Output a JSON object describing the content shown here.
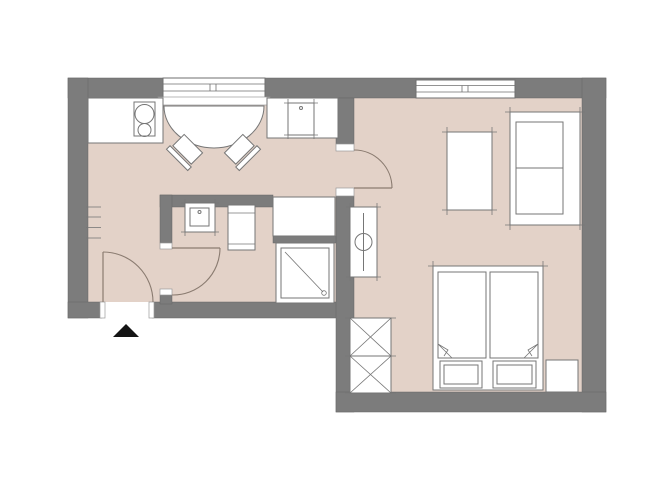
{
  "title": "Apartment floor plan",
  "canvas": {
    "width": 670,
    "height": 503,
    "background": "#ffffff"
  },
  "colors": {
    "wall": "#7c7c7c",
    "wall_edge": "#676767",
    "floor": "#e3d2c8",
    "furniture_fill": "#ffffff",
    "furniture_line": "#767676",
    "window_line": "#6f6f6f",
    "door_arc": "#8a7b70",
    "entrance_marker": "#141414"
  },
  "plan": {
    "windows_count": 2,
    "doors_count": 3,
    "entrance_marker": "black triangle outside entry door",
    "rooms": [
      {
        "name": "kitchen-dining",
        "items": [
          "kitchen-counter",
          "cooktop-two-burners",
          "sink-counter",
          "kitchen-sink",
          "window",
          "window-sill",
          "half-round-dining-table",
          "chair-left",
          "chair-right",
          "built-in-cabinet"
        ]
      },
      {
        "name": "hallway",
        "items": [
          "entrance-door",
          "wall-radiator-ticks",
          "entrance-marker-triangle"
        ]
      },
      {
        "name": "bathroom",
        "items": [
          "bathroom-door",
          "washbasin",
          "toilet",
          "shower"
        ]
      },
      {
        "name": "living-bedroom",
        "items": [
          "room-door",
          "window",
          "radiator",
          "table",
          "sofa",
          "double-bed",
          "mattress-left",
          "mattress-right",
          "pillow-left",
          "pillow-right",
          "nightstand",
          "wardrobe"
        ]
      }
    ]
  }
}
